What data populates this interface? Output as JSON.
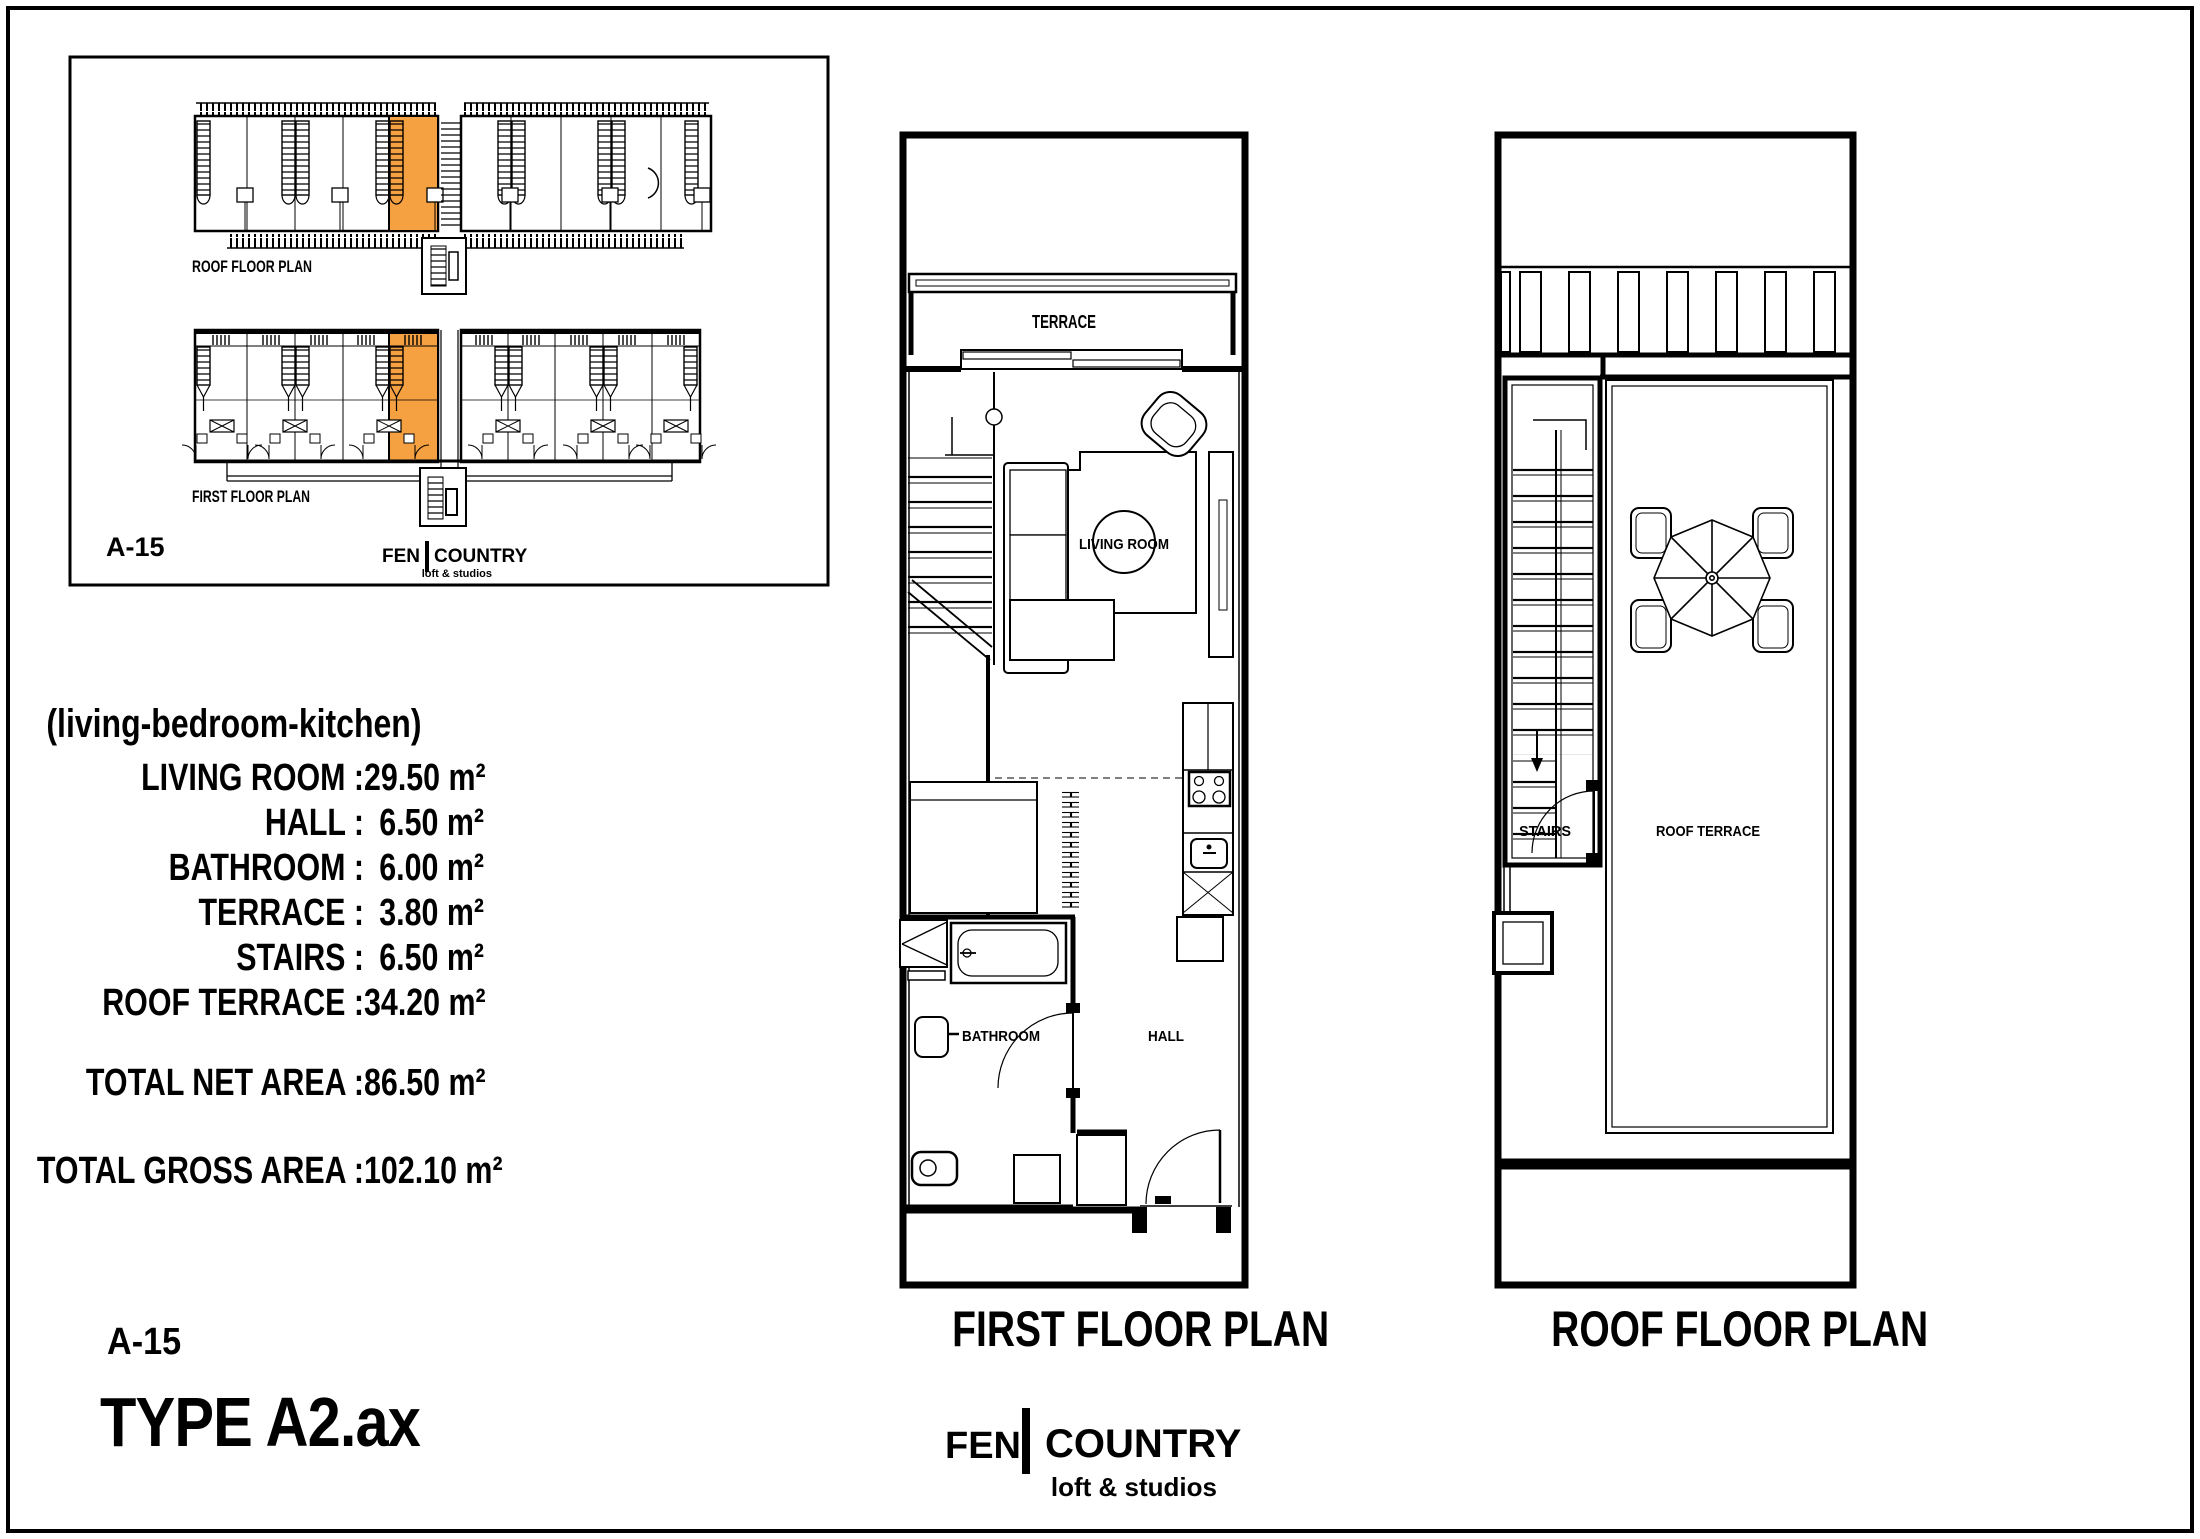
{
  "colors": {
    "highlight": "#F5A041"
  },
  "key_plan": {
    "roof_plan_label": "ROOF FLOOR PLAN",
    "first_plan_label": "FIRST FLOOR PLAN",
    "unit_code": "A-15",
    "brand_left": "FEN",
    "brand_right": "COUNTRY",
    "brand_tagline": "loft & studios"
  },
  "areas": {
    "subtitle": "(living-bedroom-kitchen)",
    "rows": [
      {
        "label": "LIVING ROOM :",
        "value": "29.50 m²"
      },
      {
        "label": "HALL :",
        "value": "6.50 m²"
      },
      {
        "label": "BATHROOM :",
        "value": "6.00 m²"
      },
      {
        "label": "TERRACE :",
        "value": "3.80 m²"
      },
      {
        "label": "STAIRS :",
        "value": "6.50 m²"
      },
      {
        "label": "ROOF TERRACE :",
        "value": "34.20 m²"
      }
    ],
    "total_net": {
      "label": "TOTAL NET AREA :",
      "value": "86.50 m²"
    },
    "total_gross": {
      "label": "TOTAL GROSS AREA :",
      "value": "102.10 m²"
    }
  },
  "unit": {
    "code": "A-15",
    "type_name": "TYPE A2.ax"
  },
  "first_floor": {
    "caption": "FIRST FLOOR PLAN",
    "terrace": "TERRACE",
    "living_room": "LIVING ROOM",
    "bathroom": "BATHROOM",
    "hall": "HALL"
  },
  "roof_floor": {
    "caption": "ROOF FLOOR PLAN",
    "stairs": "STAIRS",
    "roof_terrace": "ROOF TERRACE"
  },
  "brand": {
    "left": "FEN",
    "right": "COUNTRY",
    "tagline": "loft & studios"
  }
}
